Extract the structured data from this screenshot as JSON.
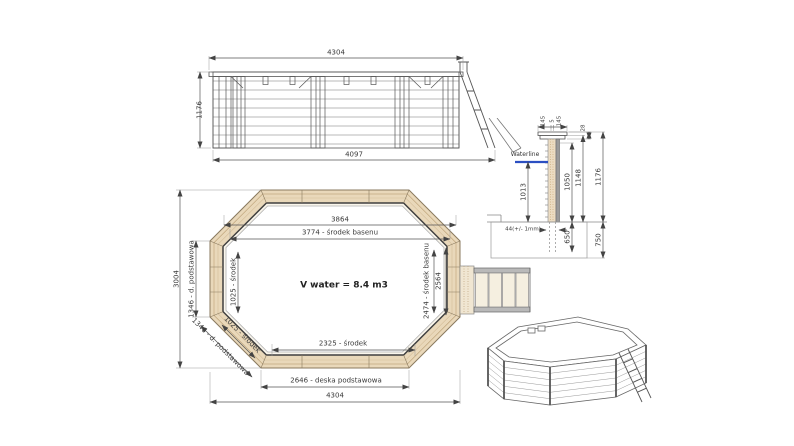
{
  "colors": {
    "line": "#555555",
    "dim_text": "#3a3a3a",
    "wood_band": "#e9d8ba",
    "waterline_blue": "#2b4fc2"
  },
  "elevation": {
    "dim_top": "4304",
    "dim_left": "1176",
    "dim_bottom": "4097"
  },
  "section": {
    "waterline_label": "Waterline",
    "cap_left": "145",
    "cap_gap": "5",
    "cap_right": "145",
    "cap_height": "28",
    "water_depth": "1013",
    "wall_inner_height": "1050",
    "wall_height": "1148",
    "total_height": "1176",
    "wall_thickness": "44(+/- 1mm)",
    "post_depth": "650",
    "foundation_depth": "750"
  },
  "plan": {
    "top_outer": "3864",
    "top_center": "3774 - środek basenu",
    "overall_height": "3004",
    "left_board": "1346 - d. podstawowa",
    "left_center": "1025 - środek",
    "diag_center": "1025 - środek",
    "diag_board": "1346 - d. podstawowa",
    "right_center": "2474 - środek basenu",
    "right_outer": "2564",
    "bottom_center": "2325 - środek",
    "bottom_board": "2646 - deska podstawowa",
    "overall_width": "4304",
    "volume": "V water = 8.4 m3"
  }
}
